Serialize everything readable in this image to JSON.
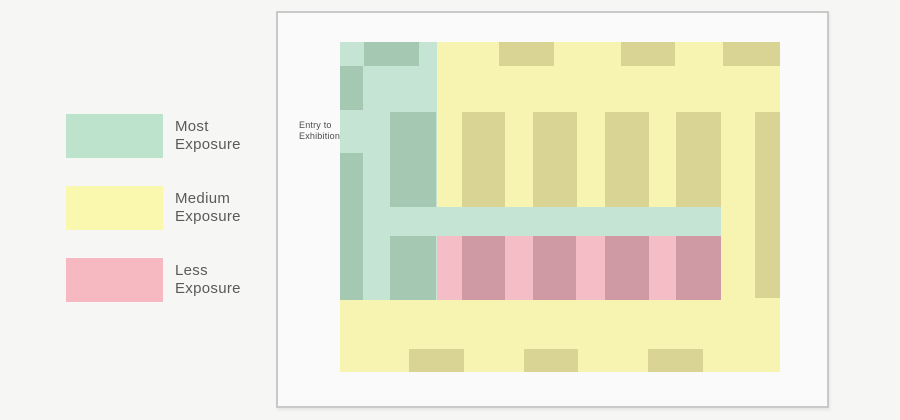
{
  "page": {
    "bg": "#f6f6f4"
  },
  "legend": {
    "items": [
      {
        "id": "most",
        "line1": "Most",
        "line2": "Exposure",
        "color": "#bee3cd"
      },
      {
        "id": "medium",
        "line1": "Medium",
        "line2": "Exposure",
        "color": "#faf7ae"
      },
      {
        "id": "less",
        "line1": "Less",
        "line2": "Exposure",
        "color": "#f6b9c1"
      }
    ]
  },
  "panel": {
    "bg": "#fafafa",
    "border": "#c9c9c9"
  },
  "entry": {
    "line1": "Entry to",
    "line2": "Exhibition",
    "arrow_color": "#3d3d35"
  },
  "floorplan": {
    "size": {
      "w": 440,
      "h": 330
    },
    "colors": {
      "most_base": "#c6e4d4",
      "most_booth": "#a4c8b2",
      "medium_base": "#f7f4b2",
      "medium_booth": "#d9d494",
      "less_base": "#f5bdc6",
      "less_booth": "#d09aa5"
    },
    "rects": [
      {
        "zone": "most",
        "kind": "base",
        "x": 0,
        "y": 0,
        "w": 97,
        "h": 258
      },
      {
        "zone": "medium",
        "kind": "base",
        "x": 97,
        "y": 0,
        "w": 343,
        "h": 165
      },
      {
        "zone": "most",
        "kind": "base",
        "x": 97,
        "y": 165,
        "w": 284,
        "h": 29
      },
      {
        "zone": "medium",
        "kind": "base",
        "x": 381,
        "y": 165,
        "w": 59,
        "h": 93
      },
      {
        "zone": "less",
        "kind": "base",
        "x": 97,
        "y": 194,
        "w": 284,
        "h": 64
      },
      {
        "zone": "medium",
        "kind": "base",
        "x": 0,
        "y": 258,
        "w": 440,
        "h": 72
      },
      {
        "zone": "most",
        "kind": "booth",
        "x": 24,
        "y": 0,
        "w": 55,
        "h": 24
      },
      {
        "zone": "most",
        "kind": "booth",
        "x": 0,
        "y": 24,
        "w": 23,
        "h": 44
      },
      {
        "zone": "most",
        "kind": "booth",
        "x": 0,
        "y": 111,
        "w": 23,
        "h": 147
      },
      {
        "zone": "most",
        "kind": "booth",
        "x": 50,
        "y": 70,
        "w": 46,
        "h": 95
      },
      {
        "zone": "most",
        "kind": "booth",
        "x": 50,
        "y": 194,
        "w": 46,
        "h": 64
      },
      {
        "zone": "medium",
        "kind": "booth",
        "x": 159,
        "y": 0,
        "w": 55,
        "h": 24
      },
      {
        "zone": "medium",
        "kind": "booth",
        "x": 281,
        "y": 0,
        "w": 54,
        "h": 24
      },
      {
        "zone": "medium",
        "kind": "booth",
        "x": 383,
        "y": 0,
        "w": 57,
        "h": 24
      },
      {
        "zone": "medium",
        "kind": "booth",
        "x": 122,
        "y": 70,
        "w": 43,
        "h": 95
      },
      {
        "zone": "medium",
        "kind": "booth",
        "x": 193,
        "y": 70,
        "w": 44,
        "h": 95
      },
      {
        "zone": "medium",
        "kind": "booth",
        "x": 265,
        "y": 70,
        "w": 44,
        "h": 95
      },
      {
        "zone": "medium",
        "kind": "booth",
        "x": 336,
        "y": 70,
        "w": 45,
        "h": 95
      },
      {
        "zone": "medium",
        "kind": "booth",
        "x": 415,
        "y": 70,
        "w": 25,
        "h": 186
      },
      {
        "zone": "medium",
        "kind": "booth",
        "x": 69,
        "y": 307,
        "w": 55,
        "h": 23
      },
      {
        "zone": "medium",
        "kind": "booth",
        "x": 184,
        "y": 307,
        "w": 54,
        "h": 23
      },
      {
        "zone": "medium",
        "kind": "booth",
        "x": 308,
        "y": 307,
        "w": 55,
        "h": 23
      },
      {
        "zone": "less",
        "kind": "booth",
        "x": 122,
        "y": 194,
        "w": 43,
        "h": 64
      },
      {
        "zone": "less",
        "kind": "booth",
        "x": 193,
        "y": 194,
        "w": 43,
        "h": 64
      },
      {
        "zone": "less",
        "kind": "booth",
        "x": 265,
        "y": 194,
        "w": 44,
        "h": 64
      },
      {
        "zone": "less",
        "kind": "booth",
        "x": 336,
        "y": 194,
        "w": 45,
        "h": 64
      }
    ]
  }
}
